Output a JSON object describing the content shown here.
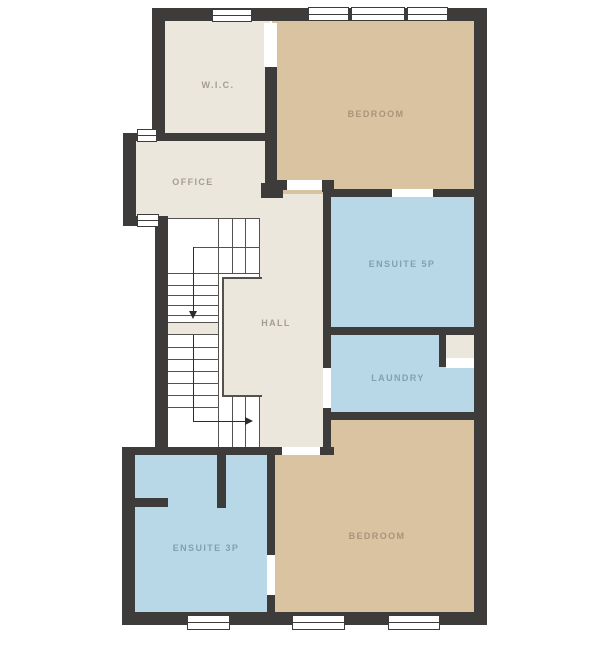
{
  "plan_title": "floor-plan",
  "palette": {
    "page_bg": "#FFFFFF",
    "wall": "#3E3C3A",
    "line": "#55524E",
    "walkline": "#2E2C2A",
    "cream": "#ECE7DC",
    "tan": "#D9C3A1",
    "blue": "#B8D8E7",
    "label_cream": "#A39E92",
    "label_tan": "#A8947A",
    "label_blue": "#84A0AE"
  },
  "rooms": [
    {
      "id": "wic",
      "label": "W.I.C.",
      "tone": "cream"
    },
    {
      "id": "office",
      "label": "OFFICE",
      "tone": "cream"
    },
    {
      "id": "bedroom-top",
      "label": "BEDROOM",
      "tone": "tan"
    },
    {
      "id": "ensuite-5p",
      "label": "ENSUITE 5P",
      "tone": "blue"
    },
    {
      "id": "hall",
      "label": "HALL",
      "tone": "cream"
    },
    {
      "id": "laundry",
      "label": "LAUNDRY",
      "tone": "blue"
    },
    {
      "id": "ensuite-3p",
      "label": "ENSUITE 3P",
      "tone": "blue"
    },
    {
      "id": "bedroom-bottom",
      "label": "BEDROOM",
      "tone": "tan"
    }
  ]
}
